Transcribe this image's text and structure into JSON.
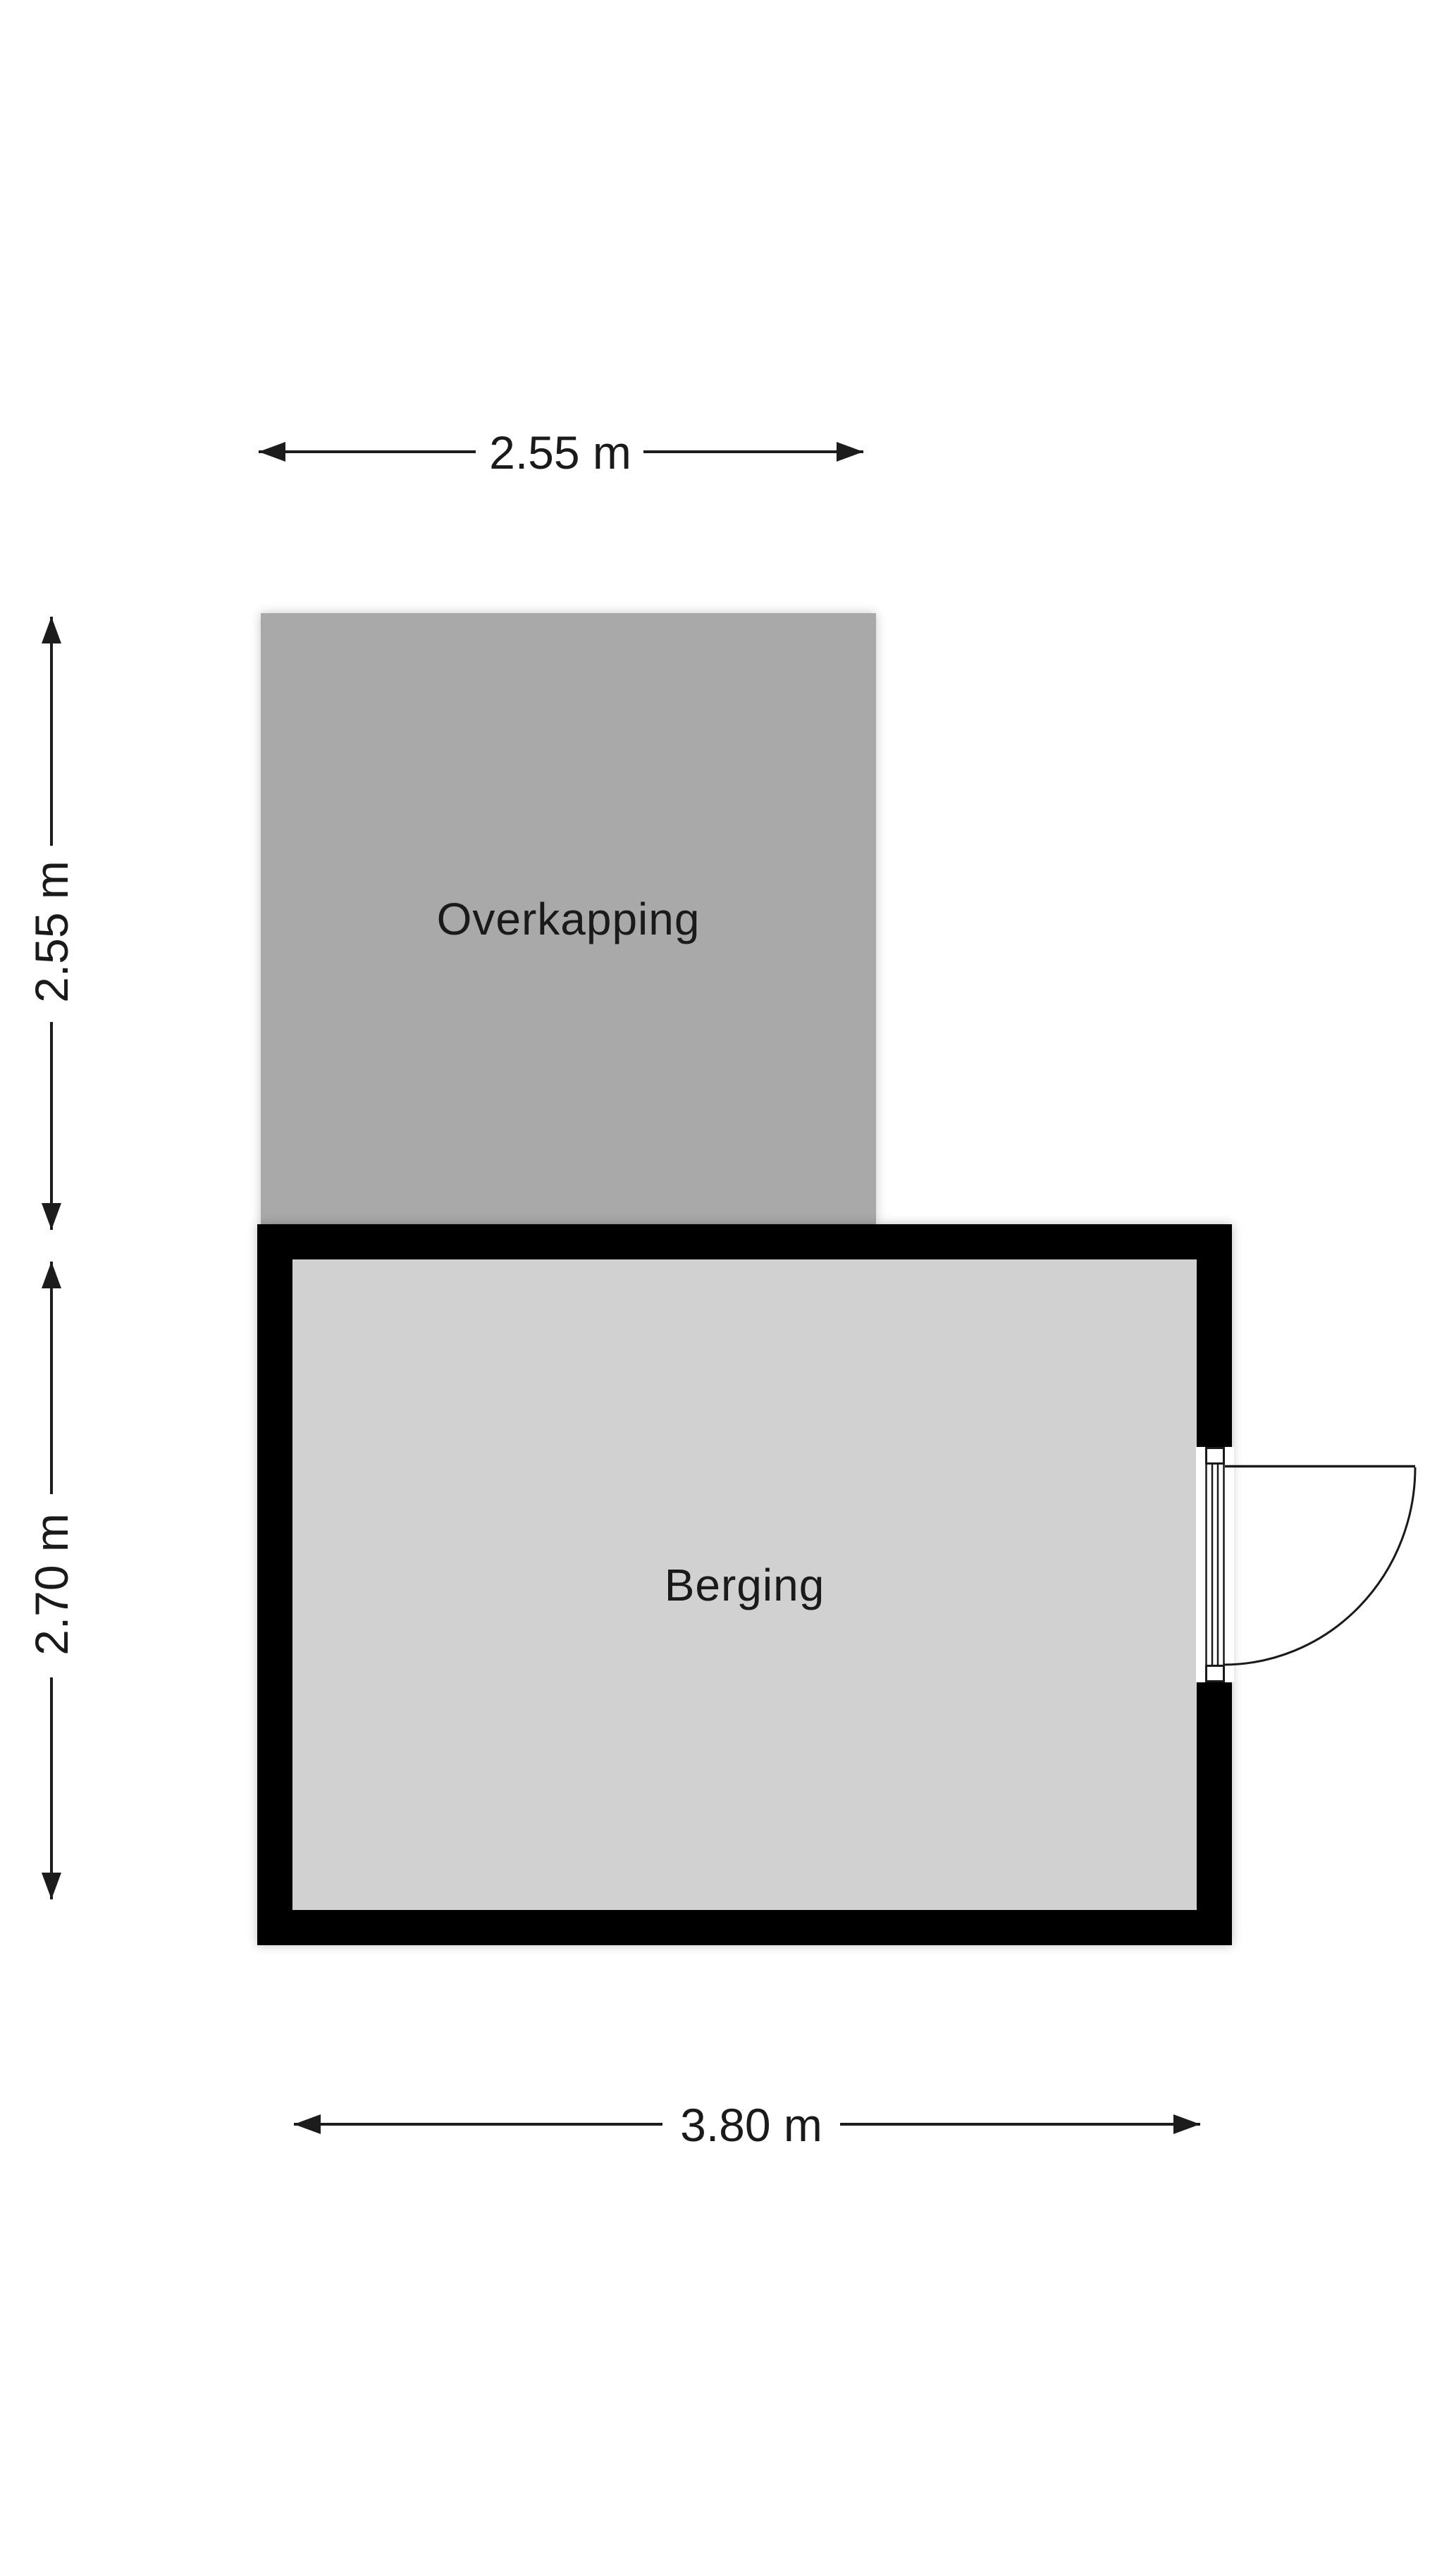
{
  "colors": {
    "background": "#ffffff",
    "wall": "#000000",
    "dimension_line": "#1c1c1c",
    "label_text": "#1a1a1a",
    "overkapping_fill": "#a9a9a9",
    "berging_floor_fill": "#d1d1d1",
    "door_line": "#1a1a1a",
    "door_fill": "#ffffff"
  },
  "rooms": {
    "overkapping": {
      "label": "Overkapping"
    },
    "berging": {
      "label": "Berging"
    }
  },
  "dimensions": {
    "top": {
      "label": "2.55 m"
    },
    "left_upper": {
      "label": "2.55 m"
    },
    "left_lower": {
      "label": "2.70 m"
    },
    "bottom": {
      "label": "3.80 m"
    }
  }
}
